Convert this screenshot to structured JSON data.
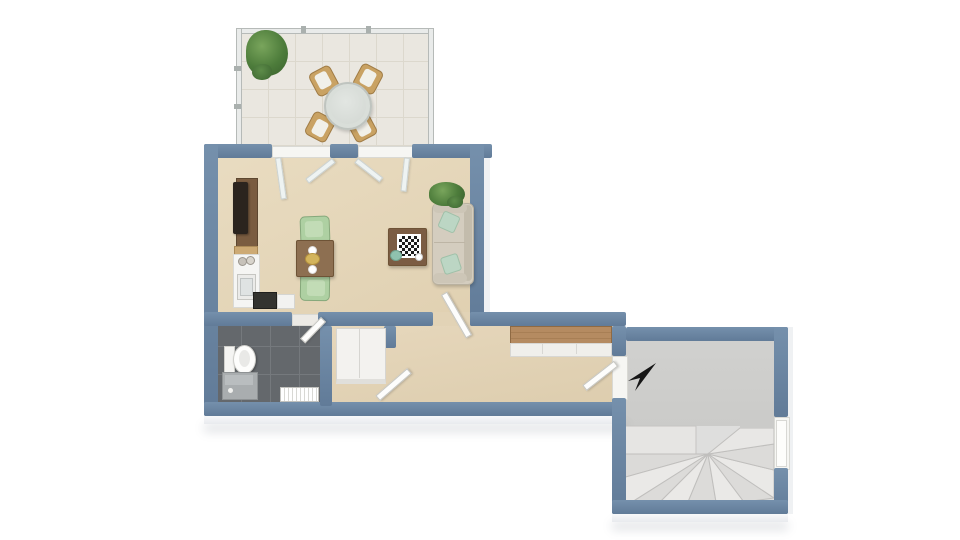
{
  "scene": {
    "description": "3D top-down floor plan render of a small apartment: glass-railed terrace, living-dining room with kitchenette, bathroom, hallway with closet and sideboard, and a staircase room with winder stairs",
    "background_color": "#ffffff",
    "visible_text": "none"
  },
  "colors": {
    "wall_cap": "#6b85a1",
    "living_floor": "#e4d5b8",
    "terrace_floor": "#eae7e0",
    "bathroom_floor": "#64686c",
    "stair_floor": "#cbcbc9",
    "wood_accent": "#b1895f",
    "mint_accent": "#aed0a2",
    "sofa": "#d4cdbf",
    "arrow": "#161616"
  },
  "rooms": [
    {
      "name": "terrace",
      "floor": "light ceramic tile",
      "enclosure": "glass railing",
      "items": [
        "potted plant",
        "round glass dining table",
        "four wooden chairs with white cushions"
      ]
    },
    {
      "name": "living-dining-room",
      "floor": "beige",
      "items": [
        "wall tv on media unit",
        "kitchenette counter with sink and two jars",
        "stove",
        "dishwasher",
        "square dining table with two plates and a dish",
        "two mint dining chairs",
        "coffee table with chessboard, teapot and cup",
        "beige sofa with two mint cushions",
        "corner potted plant"
      ],
      "doors": [
        "two open glass doors to terrace",
        "open door to hallway"
      ]
    },
    {
      "name": "bathroom",
      "floor": "dark gray tile",
      "items": [
        "toilet",
        "shower vanity",
        "radiator"
      ],
      "doors": [
        "open door from hallway"
      ]
    },
    {
      "name": "hallway",
      "floor": "beige",
      "items": [
        "built-in closet",
        "sideboard with wood top"
      ],
      "doors": [
        "open door to stair room",
        "open vestibule door"
      ]
    },
    {
      "name": "stair-room",
      "floor": "gray concrete",
      "items": [
        "winder staircase",
        "black direction arrow pointing southwest"
      ],
      "doors": [
        "entrance door in right wall"
      ]
    }
  ]
}
